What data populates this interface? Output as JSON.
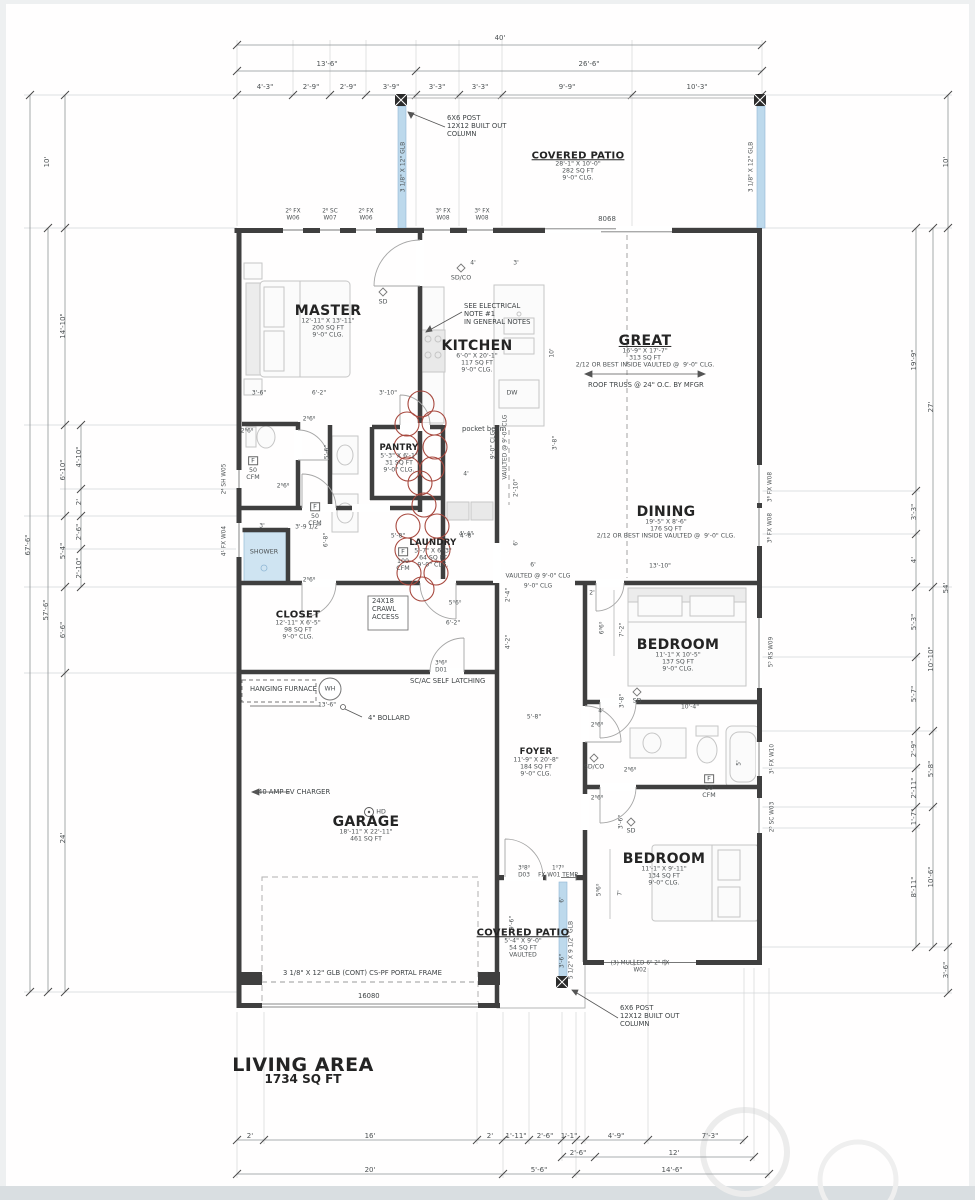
{
  "drawing": {
    "type": "residential-floor-plan",
    "living_area_label": "LIVING AREA",
    "living_area_value": "1734 SQ FT"
  },
  "rooms": [
    {
      "n": "MASTER",
      "s": [
        "12'-11\" X 13'-11\"",
        "200 SQ FT",
        "9'-0\" CLG."
      ],
      "x": 328,
      "y": 311,
      "st": "lg"
    },
    {
      "n": "KITCHEN",
      "s": [
        "6'-0\" X 20'-1\"",
        "117 SQ FT",
        "9'-0\" CLG."
      ],
      "x": 477,
      "y": 346,
      "st": "lg"
    },
    {
      "n": "GREAT",
      "s": [
        "16'-9\" X 17'-7\"",
        "313 SQ FT",
        "2/12 OR BEST INSIDE VAULTED @  9'-0\" CLG."
      ],
      "x": 645,
      "y": 341,
      "st": "lgu"
    },
    {
      "n": "DINING",
      "s": [
        "19'-5\" X 8'-6\"",
        "176 SQ FT",
        "2/12 OR BEST INSIDE VAULTED @  9'-0\" CLG."
      ],
      "x": 666,
      "y": 512,
      "st": "lg"
    },
    {
      "n": "PANTRY",
      "s": [
        "5'-3\" X 6'-1\"",
        "31 SQ FT",
        "9'-0\" CLG."
      ],
      "x": 399,
      "y": 449,
      "st": "sm"
    },
    {
      "n": "LAUNDRY",
      "s": [
        "5'-7\" X 6'-3\"",
        "64 SQ FT",
        "9'-0\" CLG."
      ],
      "x": 433,
      "y": 544,
      "st": "sm"
    },
    {
      "n": "CLOSET",
      "s": [
        "12'-11\" X 6'-5\"",
        "98 SQ FT",
        "9'-0\" CLG."
      ],
      "x": 298,
      "y": 615,
      "st": "md"
    },
    {
      "n": "GARAGE",
      "s": [
        "18'-11\" X 22'-11\"",
        "461 SQ FT"
      ],
      "x": 366,
      "y": 822,
      "st": "lg"
    },
    {
      "n": "FOYER",
      "s": [
        "11'-9\" X 20'-8\"",
        "184 SQ FT",
        "9'-0\" CLG."
      ],
      "x": 536,
      "y": 753,
      "st": "sm"
    },
    {
      "n": "BEDROOM",
      "s": [
        "11'-1\" X 10'-5\"",
        "137 SQ FT",
        "9'-0\" CLG."
      ],
      "x": 678,
      "y": 645,
      "st": "lg"
    },
    {
      "n": "BEDROOM",
      "s": [
        "11'-1\" X 9'-11\"",
        "134 SQ FT",
        "9'-0\" CLG."
      ],
      "x": 664,
      "y": 859,
      "st": "lg"
    },
    {
      "n": "COVERED PATIO",
      "s": [
        "28'-1\" X 10'-0\"",
        "282 SQ FT",
        "9'-0\" CLG."
      ],
      "x": 578,
      "y": 156,
      "st": "mdu"
    },
    {
      "n": "COVERED PATIO",
      "s": [
        "5'-4\" X 9'-0\"",
        "54 SQ FT",
        "VAULTED"
      ],
      "x": 523,
      "y": 933,
      "st": "mdu"
    },
    {
      "n": "LIVING AREA",
      "s": [
        "1734 SQ FT"
      ],
      "x": 303,
      "y": 1066,
      "st": "xl"
    }
  ],
  "dims_top": [
    [
      "40'",
      500,
      38
    ],
    [
      "13'-6\"",
      327,
      64
    ],
    [
      "26'-6\"",
      589,
      64
    ],
    [
      "4'-3\"",
      265,
      87
    ],
    [
      "2'-9\"",
      311,
      87
    ],
    [
      "2'-9\"",
      348,
      87
    ],
    [
      "3'-9\"",
      391,
      87
    ],
    [
      "3'-3\"",
      437,
      87
    ],
    [
      "3'-3\"",
      480,
      87
    ],
    [
      "9'-9\"",
      567,
      87
    ],
    [
      "10'-3\"",
      697,
      87
    ],
    [
      "8068",
      607,
      219
    ]
  ],
  "dims_left": [
    [
      "67'-6\"",
      28,
      545
    ],
    [
      "57'-6\"",
      46,
      610
    ],
    [
      "10'",
      47,
      162
    ],
    [
      "14'-10\"",
      63,
      326
    ],
    [
      "6'-10\"",
      63,
      470
    ],
    [
      "5'-4\"",
      63,
      551
    ],
    [
      "6'-6\"",
      63,
      630
    ],
    [
      "24'",
      63,
      838
    ],
    [
      "4'-10\"",
      79,
      457
    ],
    [
      "2'",
      79,
      502
    ],
    [
      "2'-6\"",
      79,
      532
    ],
    [
      "2'-10\"",
      79,
      568
    ]
  ],
  "dims_right": [
    [
      "10'",
      946,
      162
    ],
    [
      "19'-9\"",
      914,
      360
    ],
    [
      "27'",
      931,
      407
    ],
    [
      "3'-3\"",
      914,
      512
    ],
    [
      "4'",
      914,
      560
    ],
    [
      "54'",
      946,
      588
    ],
    [
      "5'-3\"",
      914,
      622
    ],
    [
      "10'-10\"",
      931,
      659
    ],
    [
      "5'-7\"",
      914,
      694
    ],
    [
      "2'-9\"",
      914,
      749
    ],
    [
      "5'-8\"",
      931,
      769
    ],
    [
      "2'-11\"",
      914,
      788
    ],
    [
      "1'-7\"",
      914,
      817
    ],
    [
      "10'-6\"",
      931,
      877
    ],
    [
      "8'-11\"",
      914,
      887
    ],
    [
      "3'-6\"",
      946,
      970
    ]
  ],
  "dims_bottom": [
    [
      "2'",
      250,
      1136
    ],
    [
      "16'",
      370,
      1136
    ],
    [
      "2'",
      490,
      1136
    ],
    [
      "1'-11\"",
      516,
      1136
    ],
    [
      "2'-6\"",
      545,
      1136
    ],
    [
      "1'-1\"",
      569,
      1136
    ],
    [
      "4'-9\"",
      616,
      1136
    ],
    [
      "7'-3\"",
      710,
      1136
    ],
    [
      "2'-6\"",
      578,
      1153
    ],
    [
      "12'",
      674,
      1153
    ],
    [
      "20'",
      370,
      1170
    ],
    [
      "5'-6\"",
      539,
      1170
    ],
    [
      "14'-6\"",
      672,
      1170
    ]
  ],
  "small_dims": [
    [
      "3'-6\"",
      259,
      394
    ],
    [
      "6'-2\"",
      319,
      394
    ],
    [
      "3'-10\"",
      388,
      394
    ],
    [
      "4'",
      473,
      264
    ],
    [
      "3'",
      516,
      264
    ],
    [
      "3'",
      262,
      527
    ],
    [
      "3'-9 1/2\"",
      308,
      528
    ],
    [
      "5'-8\"",
      398,
      537
    ],
    [
      "4'-8\"",
      467,
      537
    ],
    [
      "4'",
      466,
      475
    ],
    [
      "4'-4\"",
      466,
      535
    ],
    [
      "6'",
      533,
      566
    ],
    [
      "13'-10\"",
      660,
      567
    ],
    [
      "2'",
      592,
      594
    ],
    [
      "6'-2\"",
      453,
      624
    ],
    [
      "10'-4\"",
      690,
      708
    ],
    [
      "4'",
      601,
      712
    ],
    [
      "5'-8\"",
      534,
      718
    ],
    [
      "13'-6\"",
      327,
      706
    ],
    [
      "2⁶6⁸",
      309,
      420
    ],
    [
      "2⁶6⁸",
      247,
      432
    ],
    [
      "2⁶6⁸",
      283,
      487
    ],
    [
      "2⁶6⁸",
      309,
      581
    ],
    [
      "2⁶6⁸",
      597,
      726
    ],
    [
      "2⁶6⁸",
      630,
      771
    ],
    [
      "2⁶6⁸",
      597,
      799
    ],
    [
      "5⁰6⁰",
      455,
      604
    ],
    [
      "VAULTED @ 9'-0\" CLG",
      538,
      577
    ],
    [
      "9'-0\" CLG",
      538,
      587
    ]
  ],
  "small_dims_v": [
    [
      "5'-6\"",
      328,
      452
    ],
    [
      "6'-8\"",
      327,
      540
    ],
    [
      "10'",
      553,
      353
    ],
    [
      "3'-8\"",
      556,
      443
    ],
    [
      "2'-10\"",
      517,
      488
    ],
    [
      "6'",
      517,
      543
    ],
    [
      "7'-2\"",
      623,
      630
    ],
    [
      "6⁰6⁰",
      603,
      628
    ],
    [
      "3'-8\"",
      623,
      701
    ],
    [
      "3'-6\"",
      622,
      822
    ],
    [
      "5'",
      740,
      763
    ],
    [
      "2'-4\"",
      509,
      595
    ],
    [
      "4'-2\"",
      509,
      642
    ],
    [
      "9'-6\"",
      513,
      923
    ],
    [
      "6'",
      563,
      900
    ],
    [
      "3'-6\"",
      563,
      961
    ],
    [
      "5⁰6⁰",
      600,
      890
    ],
    [
      "7'",
      621,
      893
    ],
    [
      "VAULTED @ 9'-0\" CLG",
      506,
      447
    ],
    [
      "9'-0\" CLG",
      494,
      445
    ],
    [
      "3 1/8\" X 12\" GLB",
      404,
      167
    ],
    [
      "3 1/8\" X 12\" GLB",
      752,
      167
    ],
    [
      "5 1/2\" X 9 1/2\" GLB",
      572,
      950
    ]
  ],
  "window_labels": [
    [
      "2⁶ FX\nW06",
      293,
      215
    ],
    [
      "2⁶ SC\nW07",
      330,
      215
    ],
    [
      "2⁶ FX\nW06",
      366,
      215
    ],
    [
      "3⁶ FX\nW08",
      443,
      215
    ],
    [
      "3⁶ FX\nW08",
      482,
      215
    ],
    [
      "3⁶6⁸\nD01",
      441,
      667
    ],
    [
      "3⁰8⁰\nD03",
      524,
      872
    ],
    [
      "1⁰7⁰\nFX W01 TEMP",
      558,
      872
    ],
    [
      "(3) MULLED 6⁰ 2⁰ FX\nW02",
      640,
      967
    ]
  ],
  "window_labels_v": [
    [
      "2⁴ SH W05",
      225,
      479
    ],
    [
      "4¹ FX W04",
      225,
      541
    ],
    [
      "3⁶ FX W08",
      771,
      487
    ],
    [
      "3⁶ FX W08",
      771,
      528
    ],
    [
      "5⁵ RS W09",
      772,
      652
    ],
    [
      "3¹ FX W10",
      773,
      759
    ],
    [
      "2⁵ SC W03",
      773,
      817
    ]
  ],
  "markers": [
    [
      "SD",
      383,
      302
    ],
    [
      "SD/CO",
      461,
      278
    ],
    [
      "SD",
      637,
      701
    ],
    [
      "SD/CO",
      594,
      767
    ],
    [
      "SD",
      631,
      831
    ],
    [
      "HD",
      381,
      812
    ],
    [
      "DW",
      512,
      393
    ],
    [
      "WH",
      330,
      689
    ],
    [
      "F",
      253,
      461,
      "fb"
    ],
    [
      "50\nCFM",
      253,
      474
    ],
    [
      "F",
      315,
      507,
      "fb"
    ],
    [
      "50\nCFM",
      315,
      520
    ],
    [
      "F",
      403,
      552,
      "fb"
    ],
    [
      "100\nCFM",
      403,
      565
    ],
    [
      "F",
      709,
      779,
      "fb"
    ],
    [
      "50\nCFM",
      709,
      792
    ],
    [
      "SHOWER",
      264,
      552
    ]
  ],
  "notes": [
    [
      "6X6 POST\n12X12 BUILT OUT\nCOLUMN",
      447,
      115
    ],
    [
      "SEE ELECTRICAL\nNOTE #1\nIN GENERAL NOTES",
      464,
      303
    ],
    [
      "24X18\nCRAWL\nACCESS",
      372,
      598
    ],
    [
      "SC/AC SELF LATCHING",
      410,
      678
    ],
    [
      "HANGING FURNACE",
      250,
      686
    ],
    [
      "4\" BOLLARD",
      368,
      715
    ],
    [
      "40 AMP EV CHARGER",
      258,
      789
    ],
    [
      "ROOF TRUSS @ 24\" O.C. BY MFGR",
      588,
      382
    ],
    [
      "pocket beam",
      462,
      426
    ],
    [
      "3 1/8\" X 12\" GLB (CONT) CS-PF PORTAL FRAME",
      283,
      970
    ],
    [
      "16080",
      358,
      993
    ],
    [
      "6X6 POST\n12X12 BUILT OUT\nCOLUMN",
      620,
      1005
    ]
  ],
  "colors": {
    "wall": "#3f3f3f",
    "beam_blue": "#bdd9ec",
    "revision_red": "#a8493f",
    "dim_text": "#4c5153"
  }
}
